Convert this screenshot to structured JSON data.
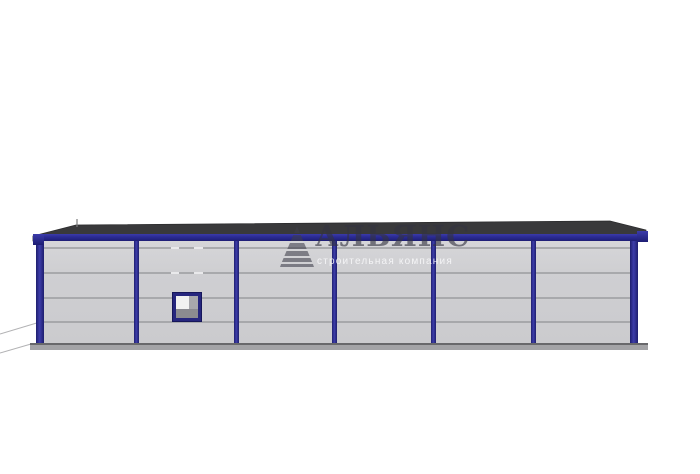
{
  "watermark": {
    "brand": "АЛЬЯНС",
    "tagline": "строительная компания"
  },
  "colors": {
    "trim_navy": "#2a2a92",
    "wall_gray": "#cfcfd2",
    "panel_line_gray": "#9b9c9f",
    "roof_dark": "#39393b",
    "base_gray": "#a3a3a6",
    "watermark_dark": "#343440",
    "watermark_light": "#fafafc",
    "background": "#ffffff"
  }
}
